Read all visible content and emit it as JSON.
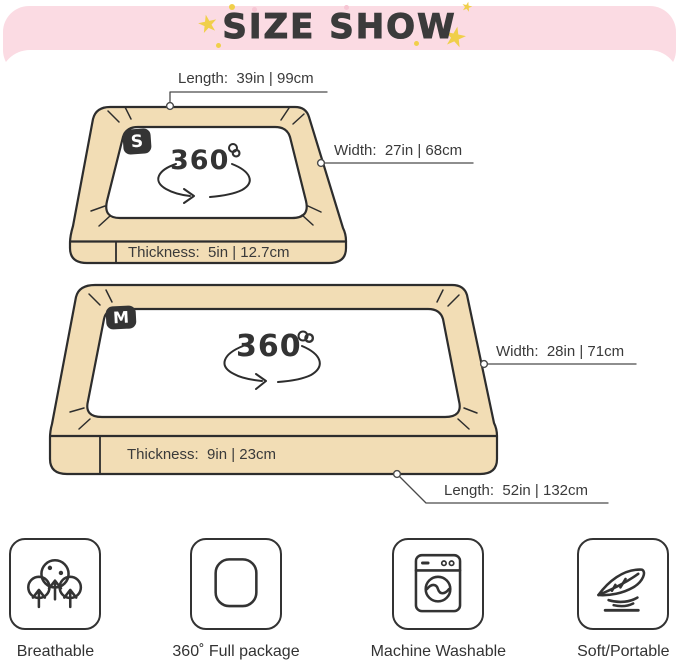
{
  "header": {
    "title": "SIZE SHOW",
    "star_glyph": "★",
    "background_color": "#FBDBE3",
    "title_color": "#3B3B3B",
    "star_color": "#F0CF4A"
  },
  "beds": [
    {
      "badge": "S",
      "rotation_label": "360°",
      "dims": {
        "length": "Length:  39in | 99cm",
        "width": "Width:  27in | 68cm",
        "thickness": "Thickness:  5in | 12.7cm"
      }
    },
    {
      "badge": "M",
      "rotation_label": "360°",
      "dims": {
        "width": "Width:  28in | 71cm",
        "thickness": "Thickness:  9in | 23cm",
        "length": "Length:  52in | 132cm"
      }
    }
  ],
  "features": [
    {
      "icon": "breathable-icon",
      "label": "Breathable"
    },
    {
      "icon": "full-package-icon",
      "label": "360˚ Full package"
    },
    {
      "icon": "machine-washable-icon",
      "label": "Machine Washable"
    },
    {
      "icon": "feather-icon",
      "label": "Soft/Portable"
    }
  ],
  "colors": {
    "bed_fill": "#F2DDB5",
    "outline": "#2D2D2D",
    "text": "#3A3A3A"
  }
}
